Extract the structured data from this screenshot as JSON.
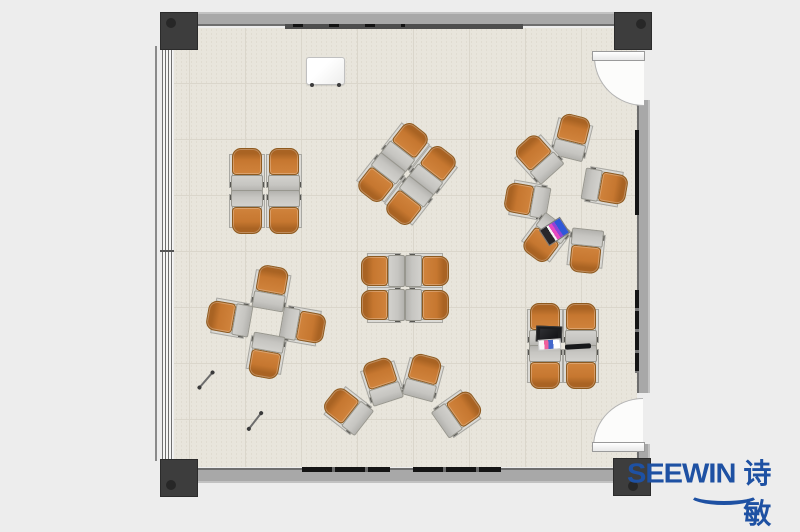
{
  "meta": {
    "description": "Top-down floor plan rendering of a classroom furnished with orange tablet-arm chairs",
    "room_label": "classroom-floor-plan"
  },
  "logo": {
    "text_en": "SEEWIN",
    "text_zh": "诗敏",
    "color": "#1e51a3"
  },
  "colors": {
    "background": "#ededed",
    "floor": "#e8e5dc",
    "floor_grid": "#dad6cb",
    "wall": "#a8a8a8",
    "wall_edge": "#6e6e6e",
    "post": "#3d3d3d",
    "chair_seat": "#c67730",
    "chair_desk": "#c6c5c1",
    "rail_dark": "#161616",
    "door_swing": "#fcfcfb"
  },
  "furniture": {
    "chair_unit": {
      "width": 36,
      "height": 44,
      "parts": [
        "seat",
        "tablet-desk",
        "armrest-left",
        "armrest-right"
      ]
    },
    "clusters": [
      {
        "name": "cluster-top-left-2x2",
        "arrangement": "2x2 facing pairs",
        "chairs": [
          {
            "x": 247,
            "y": 170,
            "r": 0
          },
          {
            "x": 284,
            "y": 170,
            "r": 0
          },
          {
            "x": 247,
            "y": 212,
            "r": 180
          },
          {
            "x": 284,
            "y": 212,
            "r": 180
          }
        ]
      },
      {
        "name": "cluster-top-center-rotated",
        "arrangement": "2x2 facing pairs rotated 38deg",
        "chairs": [
          {
            "x": 406,
            "y": 146,
            "r": 38
          },
          {
            "x": 434,
            "y": 169,
            "r": 38
          },
          {
            "x": 380,
            "y": 179,
            "r": 218
          },
          {
            "x": 408,
            "y": 202,
            "r": 218
          }
        ]
      },
      {
        "name": "cluster-center-2x2",
        "arrangement": "2x2 facing pairs sideways",
        "chairs": [
          {
            "x": 383,
            "y": 271,
            "r": -90
          },
          {
            "x": 427,
            "y": 271,
            "r": 90
          },
          {
            "x": 383,
            "y": 305,
            "r": -90
          },
          {
            "x": 427,
            "y": 305,
            "r": 90
          }
        ]
      },
      {
        "name": "cluster-left-pinwheel",
        "arrangement": "pinwheel of 4 around open center",
        "chairs": [
          {
            "x": 271,
            "y": 288,
            "r": 10
          },
          {
            "x": 303,
            "y": 326,
            "r": 100
          },
          {
            "x": 266,
            "y": 356,
            "r": 190
          },
          {
            "x": 229,
            "y": 318,
            "r": -80
          }
        ]
      },
      {
        "name": "cluster-bottom-fan",
        "arrangement": "arc of 4 facing inward",
        "chairs": [
          {
            "x": 347,
            "y": 410,
            "r": -52
          },
          {
            "x": 382,
            "y": 381,
            "r": -18
          },
          {
            "x": 423,
            "y": 377,
            "r": 15
          },
          {
            "x": 458,
            "y": 413,
            "r": 55
          }
        ]
      },
      {
        "name": "cluster-right-circle",
        "arrangement": "circle of 6 facing center",
        "chairs": [
          {
            "x": 572,
            "y": 137,
            "r": 14
          },
          {
            "x": 538,
            "y": 158,
            "r": -42
          },
          {
            "x": 527,
            "y": 200,
            "r": -80
          },
          {
            "x": 605,
            "y": 187,
            "r": 100
          },
          {
            "x": 545,
            "y": 239,
            "r": 217
          },
          {
            "x": 586,
            "y": 251,
            "r": 186
          }
        ]
      },
      {
        "name": "cluster-bottom-right-2x2",
        "arrangement": "2x2 facing pairs",
        "chairs": [
          {
            "x": 545,
            "y": 325,
            "r": 0
          },
          {
            "x": 581,
            "y": 325,
            "r": 0
          },
          {
            "x": 545,
            "y": 367,
            "r": 180
          },
          {
            "x": 581,
            "y": 367,
            "r": 180
          }
        ]
      }
    ],
    "props": [
      {
        "type": "laptop-colorful",
        "name": "tablet-with-colorful-screen",
        "x": 542,
        "y": 222,
        "r": -33
      },
      {
        "type": "laptop-open",
        "name": "open-laptop",
        "x": 536,
        "y": 326,
        "r": 2
      },
      {
        "type": "papers",
        "name": "colorful-papers",
        "x": 538,
        "y": 339,
        "r": -4
      },
      {
        "type": "laptop-closed",
        "name": "closed-laptop",
        "x": 565,
        "y": 344,
        "r": -3
      },
      {
        "type": "stick",
        "name": "pointer-stick",
        "x": 196,
        "y": 379,
        "r": -49
      },
      {
        "type": "stick",
        "name": "pointer-stick",
        "x": 245,
        "y": 420,
        "r": -52
      }
    ]
  }
}
